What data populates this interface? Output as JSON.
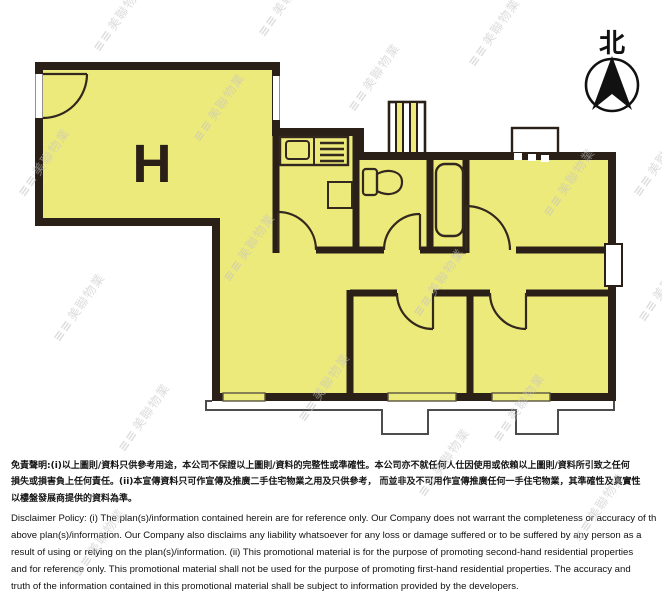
{
  "compass": {
    "label": "北"
  },
  "floor_plan": {
    "unit_label": "H",
    "fill": "#EDEA7C",
    "wall_color": "#2A2017",
    "line_color": "#33281E"
  },
  "watermark": {
    "logo_icon": "≡≡",
    "text": "美聯物業",
    "color": "#C2C2C2"
  },
  "disclaimer": {
    "zh": [
      "免責聲明:(i)以上圖則/資料只供參考用途，本公司不保證以上圖則/資料的完整性或準確性。本公司亦不就任何人仕因使用或依賴以上圖則/資料所引致之任何",
      "損失或損害負上任何責任。(ii)本宣傳資料只可作宣傳及推廣二手住宅物業之用及只供參考， 而並非及不可用作宣傳推廣任何一手住宅物業，其準確性及真實性",
      "以樓盤發展商提供的資料為準。"
    ],
    "en": [
      "Disclaimer Policy: (i) The plan(s)/information contained herein are for reference only. Our Company does not warrant the completeness or accuracy of the",
      "above plan(s)/information. Our Company also disclaims any liability whatsoever for any loss or damage suffered or to be suffered by any person as a",
      "result of using or relying on the plan(s)/information. (ii) This promotional material is for the purpose of promoting second-hand residential properties",
      "and for reference only. This promotional material shall not be used for the purpose of promoting first-hand residential properties. The accuracy and",
      "truth of the information contained in this promotional material shall be subject to information provided by the developers."
    ]
  }
}
